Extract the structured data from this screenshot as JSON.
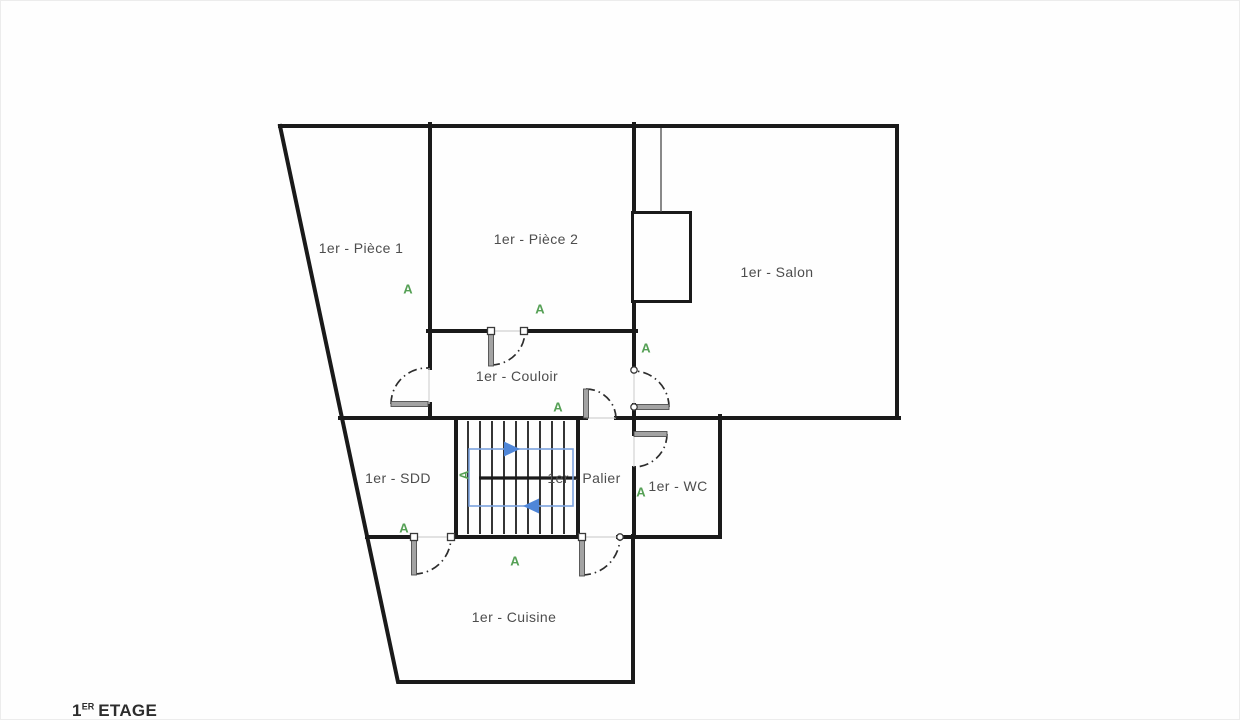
{
  "floor_label": {
    "number": "1",
    "superscript": "ER",
    "word": "ETAGE"
  },
  "annotation": {
    "letter": "A",
    "color": "#55a055",
    "meaning": "door-annotation-marker"
  },
  "rooms": {
    "piece1": {
      "label": "1er - Pièce 1"
    },
    "piece2": {
      "label": "1er - Pièce 2"
    },
    "salon": {
      "label": "1er - Salon"
    },
    "couloir": {
      "label": "1er - Couloir"
    },
    "sdd": {
      "label": "1er - SDD"
    },
    "palier": {
      "label": "1er - Palier"
    },
    "wc": {
      "label": "1er - WC"
    },
    "cuisine": {
      "label": "1er - Cuisine"
    }
  },
  "colors": {
    "wall": "#1a1a1a",
    "door_leaf": "#a3a3a3",
    "door_arc": "#2d2d2d",
    "sight_line": "#d2d2d2",
    "stair_path": "#7ba1dd",
    "stair_arrow": "#4f86d8",
    "annotation": "#55a055",
    "label_text": "#4d4d4d"
  },
  "icons": {
    "stair_up_arrow": "arrow-right",
    "stair_down_arrow": "arrow-left"
  }
}
